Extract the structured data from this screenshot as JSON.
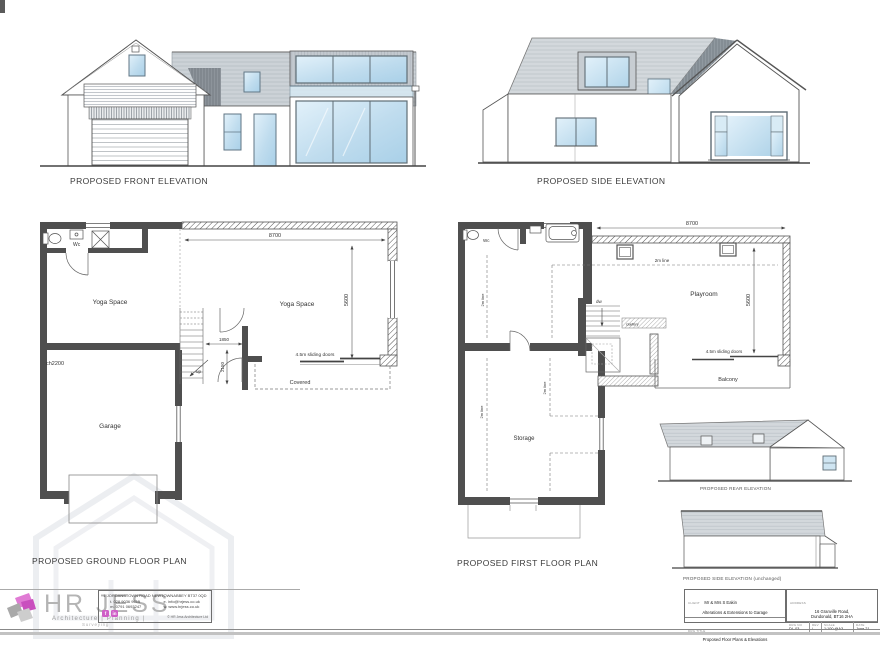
{
  "colors": {
    "accent_pink": "#cf5fc7",
    "wall_gray": "#4f4f4f",
    "roof_gray": "#ccd2d7",
    "glass_blue": "#cfe5f2"
  },
  "titles": {
    "front_elevation": "PROPOSED FRONT ELEVATION",
    "side_elevation": "PROPOSED SIDE ELEVATION",
    "ground_floor_plan": "PROPOSED GROUND FLOOR PLAN",
    "first_floor_plan": "PROPOSED FIRST FLOOR PLAN",
    "rear_elevation": "PROPOSED REAR ELEVATION",
    "side_elevation_unchanged": "PROPOSED SIDE ELEVATION (unchanged)"
  },
  "ground_floor": {
    "room_yoga_left": "Yoga Space",
    "room_yoga_right": "Yoga Space",
    "room_garage": "Garage",
    "label_wc": "Wc",
    "label_up": "up",
    "label_covered": "Covered",
    "label_ceiling_height": "ch2200",
    "label_sliding_doors": "4.5m sliding doors",
    "dim_width": "8700",
    "dim_depth": "5600",
    "dim_hall_width": "1850",
    "dim_hall_depth": "2150"
  },
  "first_floor": {
    "room_playroom": "Playroom",
    "room_storage": "Storage",
    "room_balcony": "Balcony",
    "label_wc": "Wc",
    "label_down": "dw",
    "label_gallery": "Gallery",
    "label_2m_line": "2m line",
    "label_sliding_doors": "4.5m sliding doors",
    "dim_width": "8700",
    "dim_depth": "5600"
  },
  "title_block": {
    "firm_name": "HR JESS",
    "firm_tagline": "Architecture | Planning |",
    "firm_tagline2": "Surveying",
    "firm_address": "1 JORDANSTOWN ROAD NEWTOWNABBEY BT37 0QD",
    "firm_phone": "t. 028 9036 9615",
    "firm_mobile": "m. 0791 0693247",
    "firm_email": "e. info@hrjess.co.uk",
    "firm_web": "w. www.hrjess.co.uk",
    "firm_copyright": "© HR Jess Architecture Ltd",
    "facebook_label": "f",
    "linkedin_label": "in",
    "client_label": "CLIENT",
    "client_name": "Mr & Mrs S Eakin",
    "project": "Alterations & Extensions to Garage",
    "drawing_title_label": "DRG TITLE",
    "drawing_title": "Proposed Floor Plans & Elevations",
    "address_label": "ADDRESS",
    "site_address_line1": "16 Granville Road,",
    "site_address_line2": "Dundonald, BT16 2HA",
    "drawing_no_label": "DRG NO",
    "drawing_no": "DL-03",
    "rev_label": "REV",
    "rev": "/",
    "scale_label": "SCALE",
    "scale": "1:100 @A3",
    "date_label": "DATE",
    "date": "June 21"
  }
}
